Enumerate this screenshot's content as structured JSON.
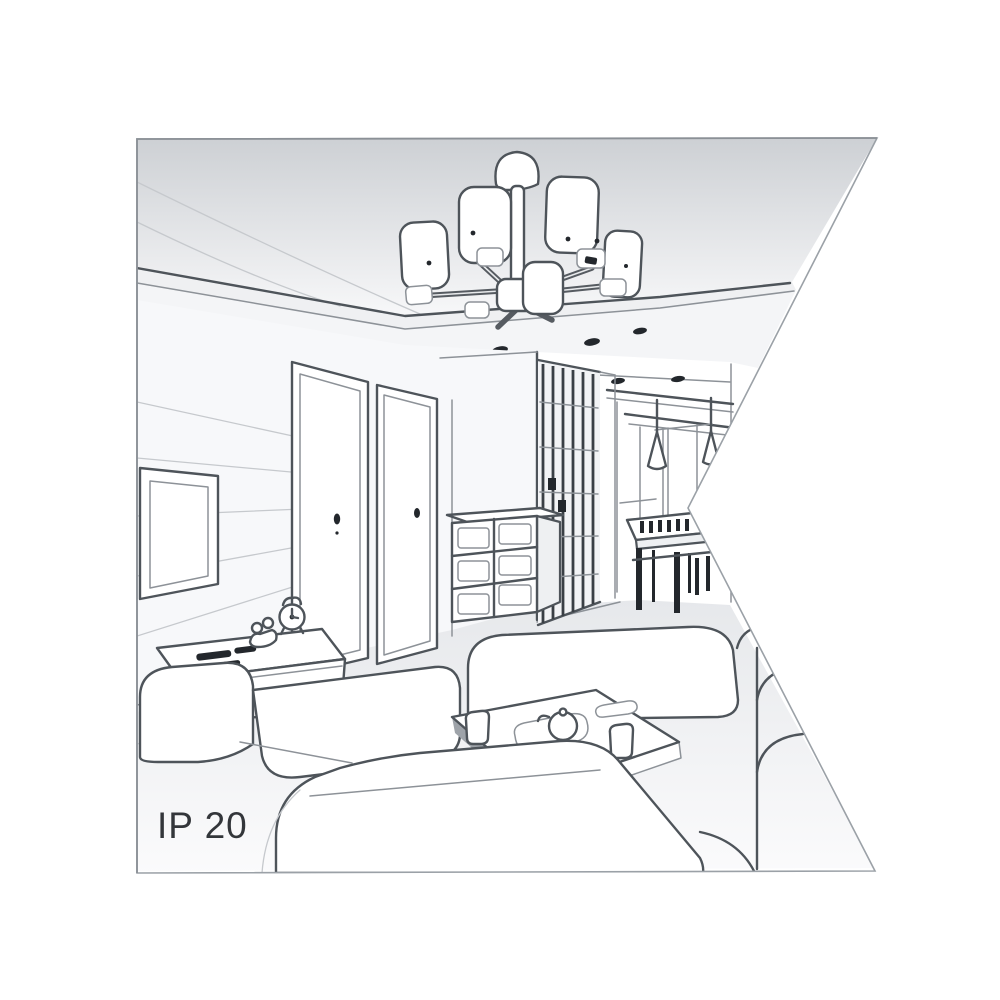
{
  "page": {
    "background": "#ffffff"
  },
  "illustration": {
    "label_ip_rating": "IP 20",
    "description": "black-and-white perspective sketch of an apartment living room interior used as lamp ambience illustration",
    "objects": [
      "chandelier-six-cylinder-shades",
      "drop-ceiling-with-spotlights",
      "tv-wall-panel",
      "flat-screen-tv",
      "tv-sideboard",
      "alarm-clock",
      "remote-controls",
      "interior-door-left",
      "interior-door-right",
      "chest-of-drawers",
      "glass-partition-wardrobe",
      "hallway-with-pendant-lamps",
      "dining-table-with-chairs",
      "corner-sofa",
      "coffee-table-with-tea-set",
      "front-sofa",
      "right-sofa"
    ],
    "colors": {
      "line": "#4e545a",
      "line_soft": "#c6c9cd",
      "ceiling_shade": "#cdd0d4",
      "wall_fill": "#f7f8fa",
      "floor_fill": "#e6e8eb",
      "dark_detail": "#23272c",
      "frame_border": "#9ba1a7",
      "text": "#33363a"
    }
  }
}
